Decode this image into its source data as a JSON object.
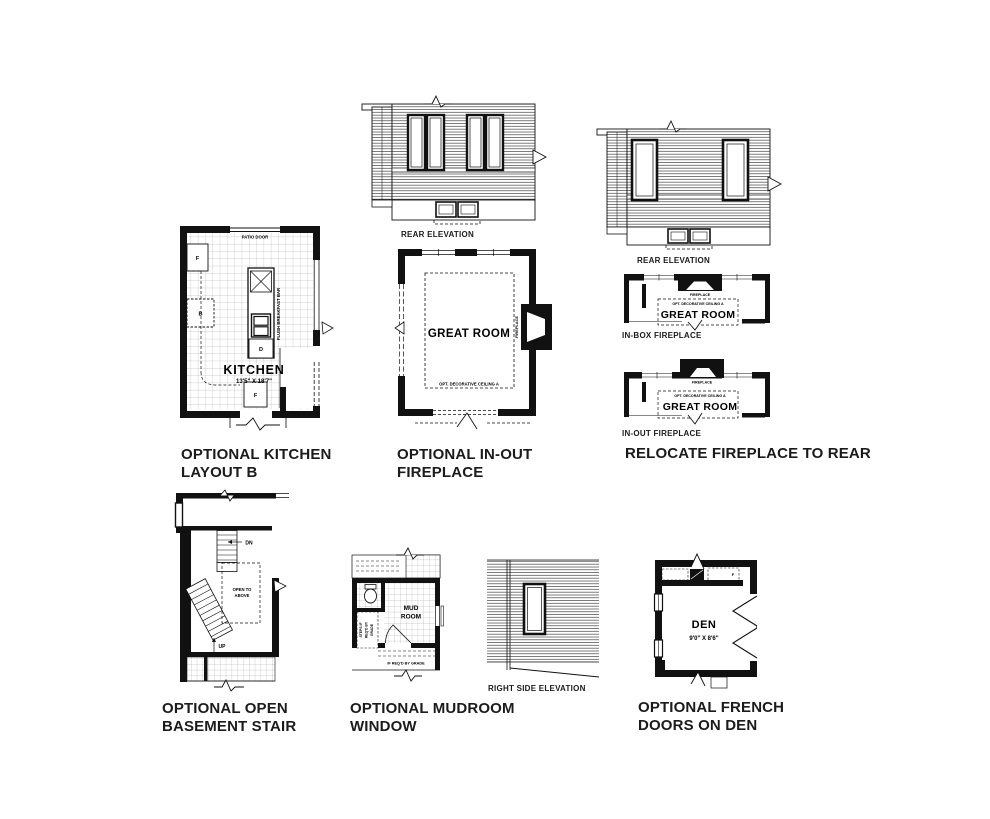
{
  "document": {
    "background": "#ffffff",
    "ink": "#111111",
    "caption_color": "#1b1b1b"
  },
  "rear_elevation_1": {
    "caption": "REAR ELEVATION"
  },
  "rear_elevation_2": {
    "caption": "REAR ELEVATION"
  },
  "kitchen": {
    "caption_line1": "OPTIONAL KITCHEN",
    "caption_line2": "LAYOUT B",
    "room_name": "KITCHEN",
    "room_dims": "13'5\" X 18'7\"",
    "patio_door_label": "PATIO DOOR",
    "breakfast_bar_label": "FLUSH BREAKFAST BAR",
    "appliance_fridge": "F",
    "appliance_oven": "B",
    "appliance_dishwasher": "D",
    "appliance_pantry": "F"
  },
  "great_room": {
    "caption_line1": "OPTIONAL IN-OUT",
    "caption_line2": "FIREPLACE",
    "room_name": "GREAT ROOM",
    "ceiling_note": "OPT. DECORATIVE CEILING A",
    "fireplace_label": "FIREPLACE"
  },
  "relocate_fireplace": {
    "caption": "RELOCATE FIREPLACE TO REAR",
    "in_box": {
      "label": "IN-BOX FIREPLACE",
      "room_name": "GREAT ROOM",
      "ceiling_note": "OPT. DECORATIVE CEILING A",
      "fireplace_label": "FIREPLACE"
    },
    "in_out": {
      "label": "IN-OUT FIREPLACE",
      "room_name": "GREAT ROOM",
      "ceiling_note": "OPT. DECORATIVE CEILING A",
      "fireplace_label": "FIREPLACE"
    }
  },
  "basement_stair": {
    "caption_line1": "OPTIONAL OPEN",
    "caption_line2": "BASEMENT STAIR",
    "down_label": "DN",
    "up_label": "UP",
    "open_above_line1": "OPEN TO",
    "open_above_line2": "ABOVE"
  },
  "mudroom": {
    "caption_line1": "OPTIONAL MUDROOM",
    "caption_line2": "WINDOW",
    "room_line1": "MUD",
    "room_line2": "ROOM",
    "steps_note_line1": "STEPS IF",
    "steps_note_line2": "REQ'D BY",
    "steps_note_line3": "GRADE",
    "grade_note": "IF REQ'D BY GRADE"
  },
  "right_side_elevation": {
    "caption": "RIGHT SIDE ELEVATION"
  },
  "den": {
    "caption_line1": "OPTIONAL FRENCH",
    "caption_line2": "DOORS ON DEN",
    "room_name": "DEN",
    "room_dims": "9'0\" X 8'6\"",
    "appliance_f": "F"
  }
}
